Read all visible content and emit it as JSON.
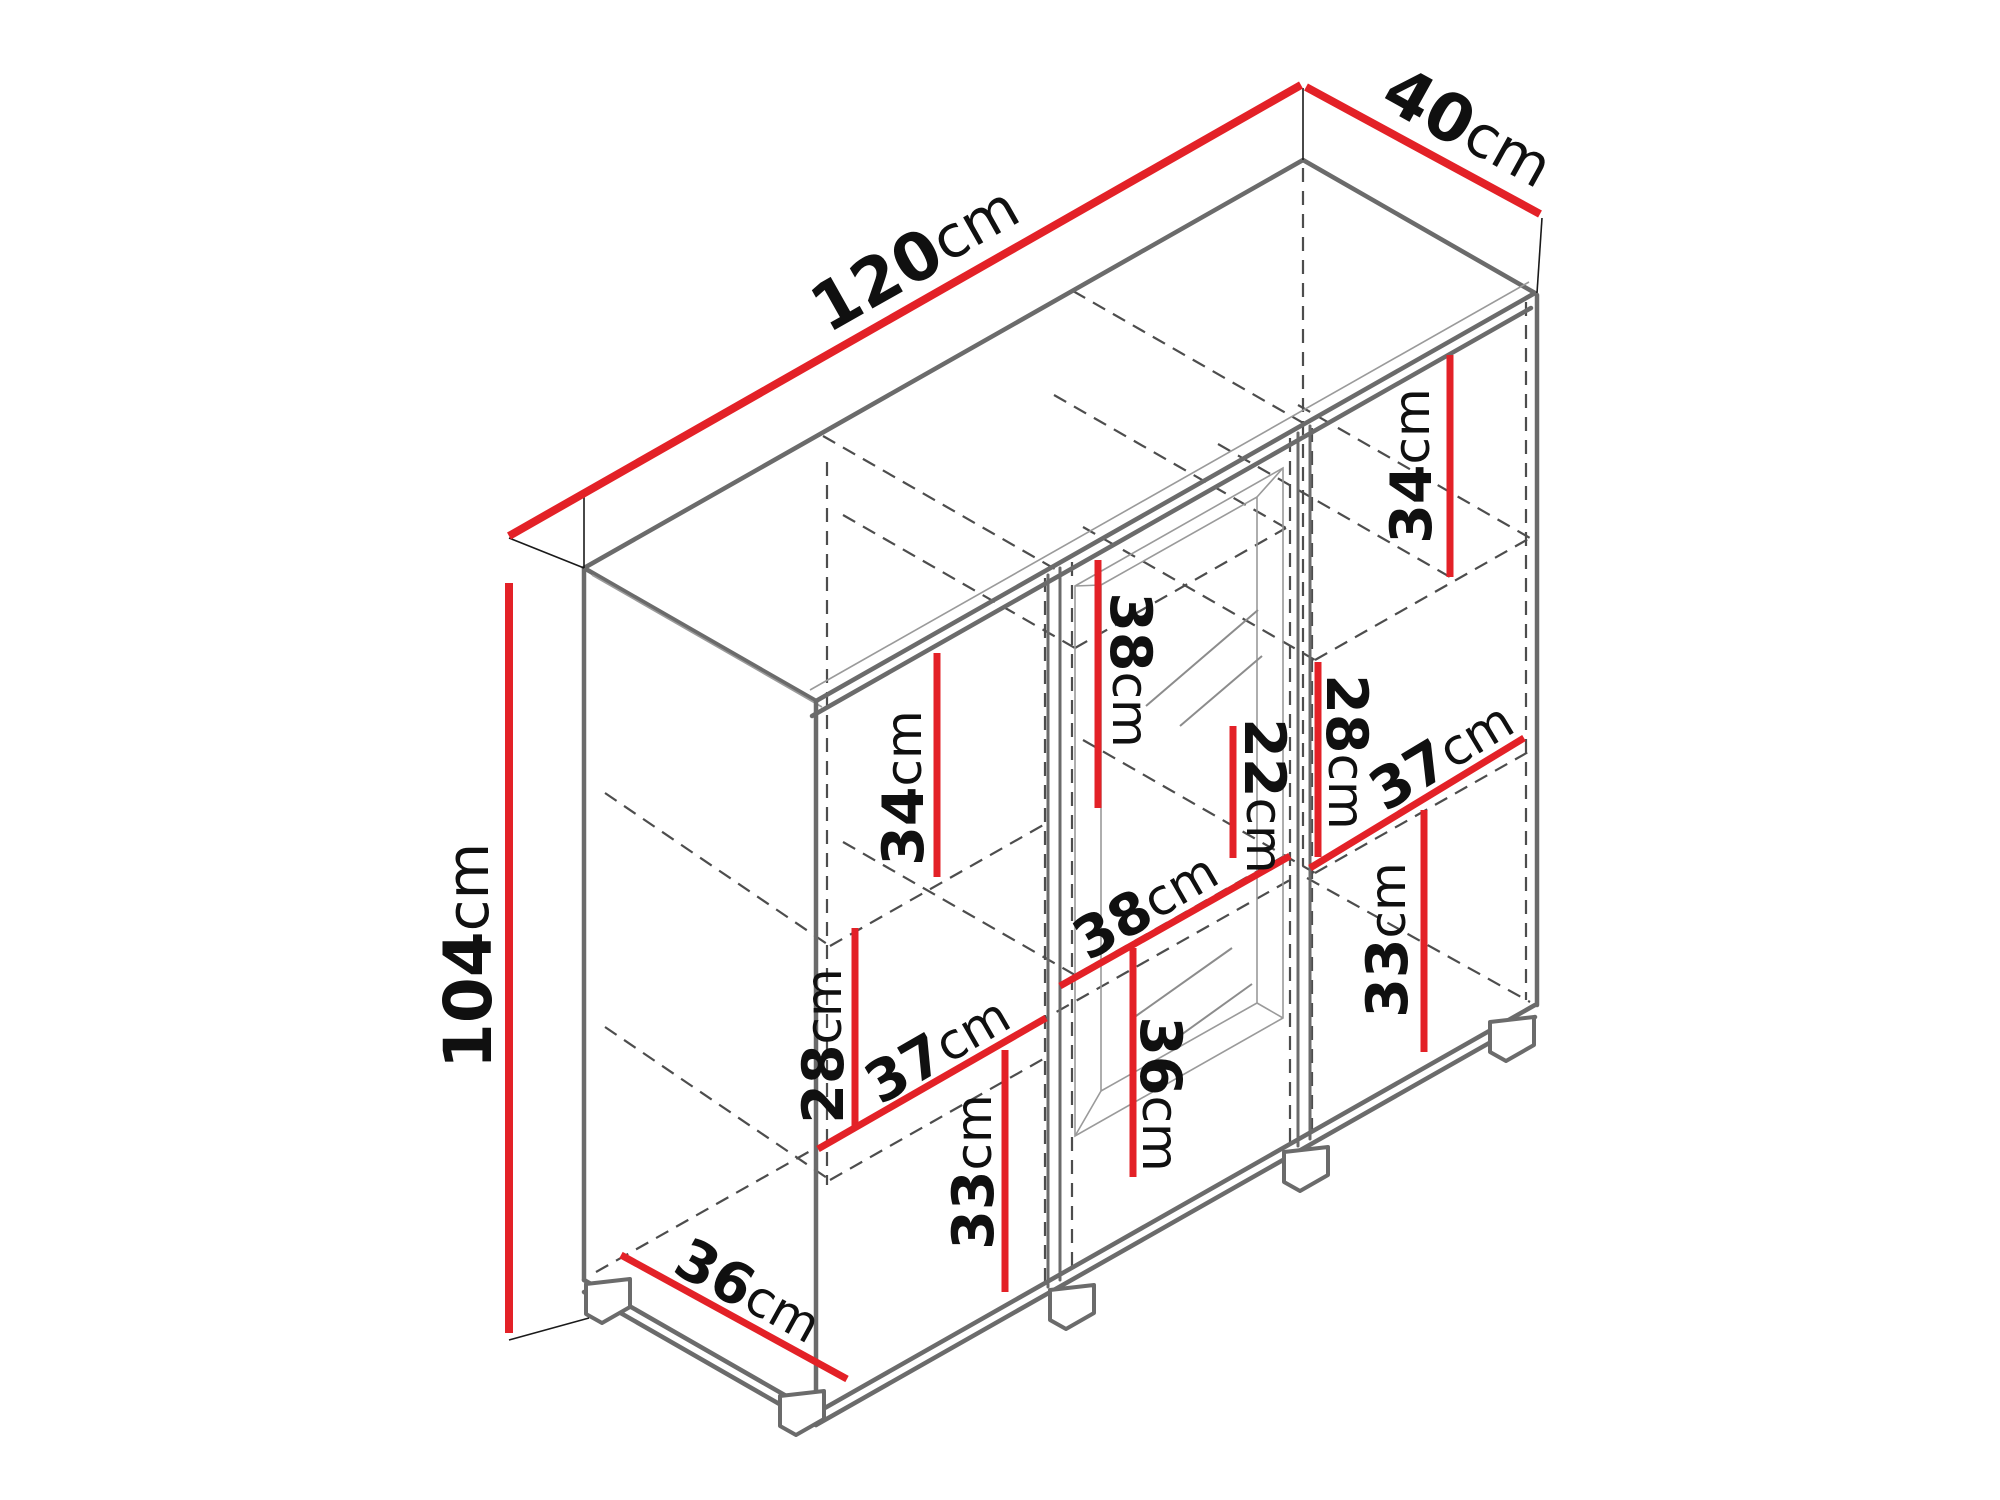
{
  "diagram": {
    "kind": "furniture-dimension-diagram",
    "unit": "cm",
    "colors": {
      "dimension_line": "#e32127",
      "cabinet_edge": "#6b6b6b",
      "hidden_line": "#4d4d4d",
      "label_text": "#101010"
    },
    "dimensions": {
      "overall": {
        "width": {
          "value": "120",
          "unit": "cm"
        },
        "depth": {
          "value": "40",
          "unit": "cm"
        },
        "height": {
          "value": "104",
          "unit": "cm"
        }
      },
      "internal": {
        "right_top": {
          "value": "34",
          "unit": "cm"
        },
        "center_upper": {
          "value": "38",
          "unit": "cm"
        },
        "left_upper": {
          "value": "34",
          "unit": "cm"
        },
        "center_glass": {
          "value": "22",
          "unit": "cm"
        },
        "right_middle": {
          "value": "28",
          "unit": "cm"
        },
        "right_width": {
          "value": "37",
          "unit": "cm"
        },
        "right_lower": {
          "value": "33",
          "unit": "cm"
        },
        "center_width": {
          "value": "38",
          "unit": "cm"
        },
        "center_lower": {
          "value": "36",
          "unit": "cm"
        },
        "left_middle": {
          "value": "28",
          "unit": "cm"
        },
        "left_width": {
          "value": "37",
          "unit": "cm"
        },
        "left_lower": {
          "value": "33",
          "unit": "cm"
        },
        "bottom_depth": {
          "value": "36",
          "unit": "cm"
        }
      }
    }
  }
}
